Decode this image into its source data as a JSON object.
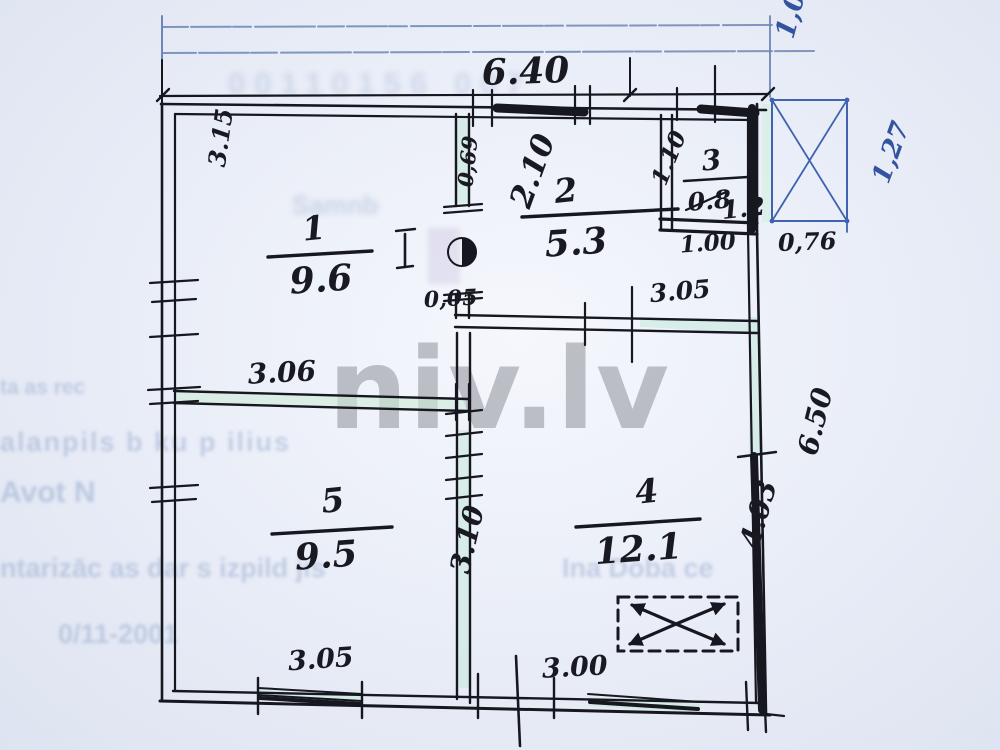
{
  "watermark": "niv.lv",
  "rooms": {
    "r1": {
      "num": "1",
      "area": "9.6"
    },
    "r2": {
      "num": "2",
      "area": "5.3"
    },
    "r3": {
      "num": "3",
      "area_old": "0.8",
      "area_new": "1.2"
    },
    "r4": {
      "num": "4",
      "area": "12.1"
    },
    "r5": {
      "num": "5",
      "area": "9.5"
    }
  },
  "dims": {
    "top_width": "6.40",
    "top_right": "1,00",
    "left_height": "3.15",
    "room2_height": "2.10",
    "door_width": "0,69",
    "door_offset": "0,05",
    "room3_height": "1.10",
    "room3_width": "1.00",
    "hall_width": "3.05",
    "mid_wall": "3.06",
    "right_outer": "6.50",
    "right_inner": "4.03",
    "center_wall": "3.10",
    "bottom_window": "3.05",
    "bottom_right": "3.00",
    "porch_height": "1,27",
    "porch_width": "0,76"
  },
  "ghost": {
    "serial": "00110156 007",
    "owner": "Samnb",
    "addr1": "ta as rec",
    "addr2": "alanpils  b ku  p ilius",
    "addr3": "Avot N",
    "surveyor_left": "ntarizāc as dar s izpild jis",
    "surveyor_right": "Ina Doba ce",
    "date": "0/11-2001"
  }
}
